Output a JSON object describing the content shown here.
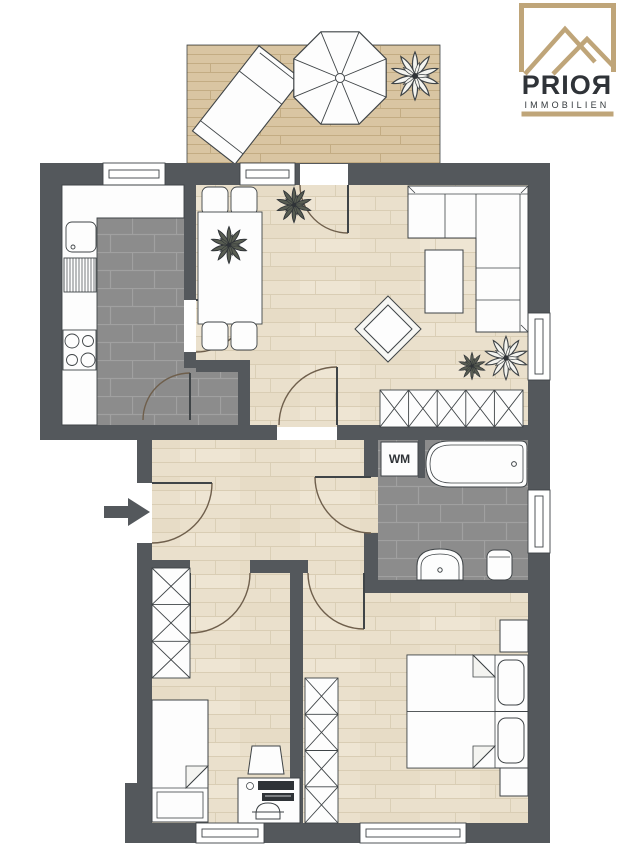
{
  "logo": {
    "brand": "PRIOЯ",
    "tagline": "IMMOBILIEN",
    "gold": "#bfa579",
    "text_color": "#2f3338"
  },
  "labels": {
    "washing_machine": "WM"
  },
  "entrance": {
    "arrow_direction": "right"
  },
  "palette": {
    "wall": "#54585c",
    "wood_floor": "#eae0cc",
    "wood_line": "#d9cdb4",
    "deck": "#d9c5a2",
    "deck_line": "#c3ac83",
    "tile": "#8c8c8c",
    "tile_grout": "#a0a0a0",
    "furniture_fill": "#fdfdfd",
    "furniture_stroke": "#3f4447",
    "door_arc": "#6f5f4c",
    "background": "#ffffff"
  },
  "furniture_icons": [
    "sun-lounger",
    "parasol",
    "plant",
    "dining-table",
    "dining-chair",
    "kitchen-counter",
    "kitchen-sink",
    "drainboard",
    "stove",
    "sofa",
    "coffee-table",
    "ottoman",
    "sideboard",
    "bathtub",
    "washing-machine",
    "bathroom-sink",
    "toilet",
    "wardrobe",
    "single-bed",
    "desk",
    "desk-chair",
    "stool",
    "double-bed",
    "nightstand",
    "pillow",
    "entry-arrow",
    "window"
  ]
}
